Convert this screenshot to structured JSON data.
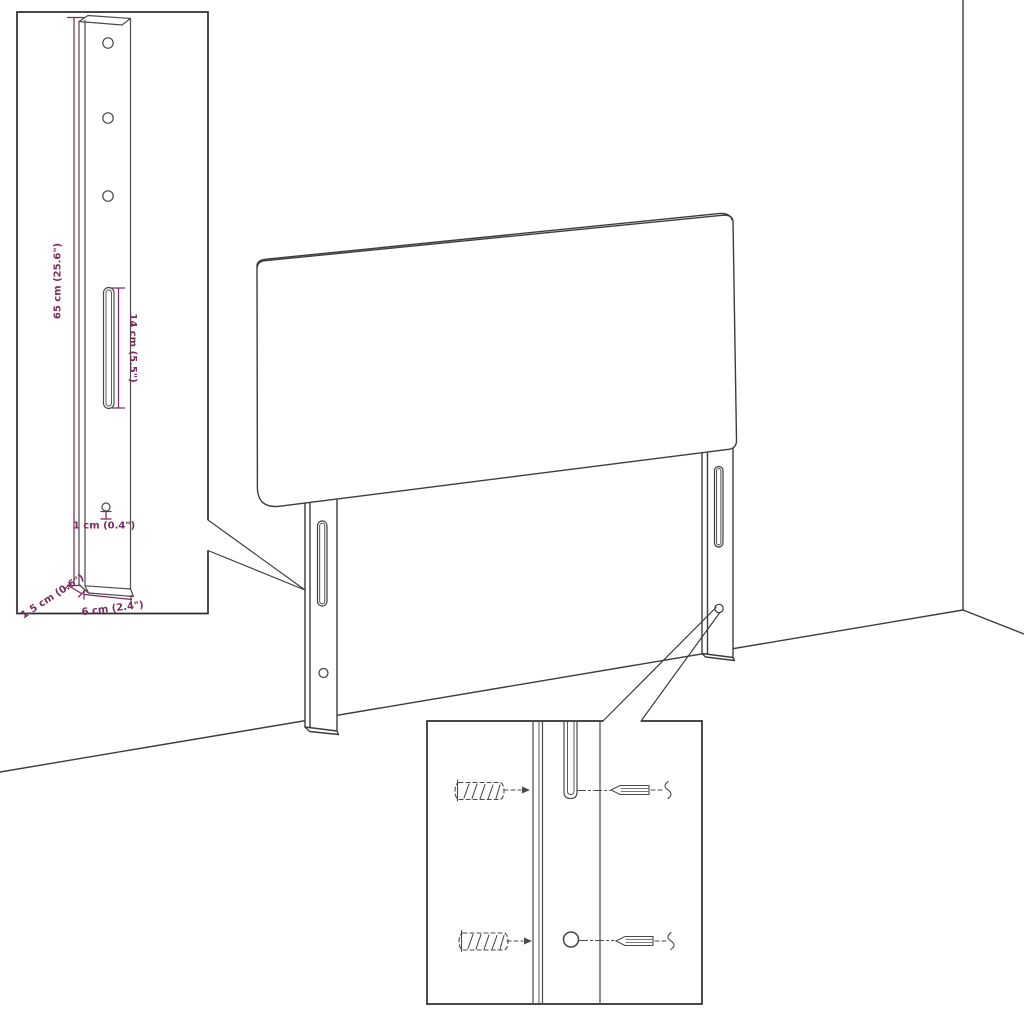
{
  "page": {
    "background": "#ffffff"
  },
  "dims": {
    "leg_height": "65 cm (25.6\")",
    "slot_length": "14 cm (5.5\")",
    "hole_diameter": "1 cm (0.4\")",
    "leg_depth": "1.5 cm (0.6\")",
    "leg_width": "6 cm (2.4\")"
  },
  "colors": {
    "dimension_text": "#7B2C5E",
    "line": "#3D3D3D",
    "background": "#FFFFFF"
  }
}
